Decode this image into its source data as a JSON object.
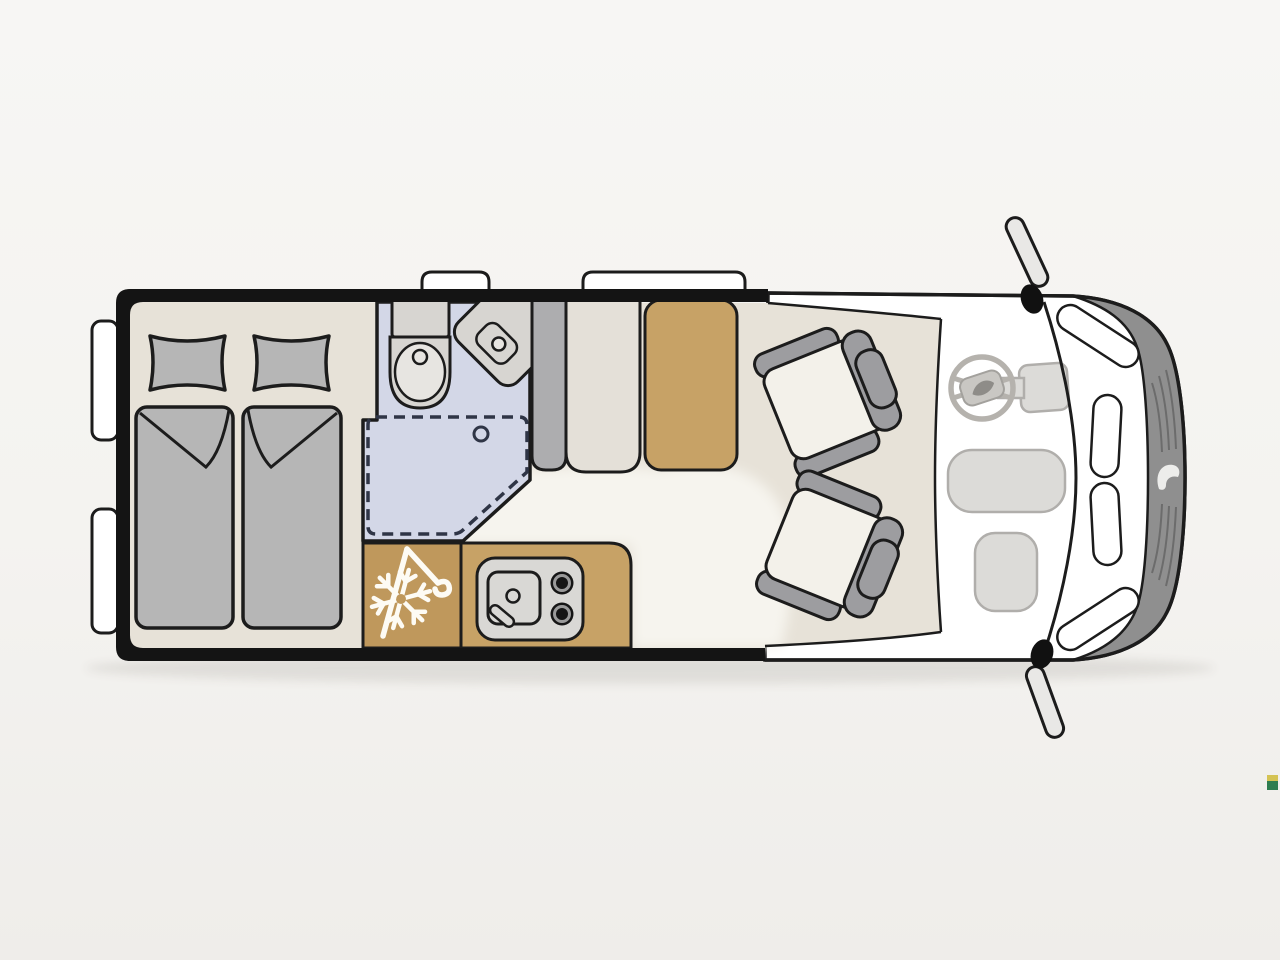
{
  "diagram": {
    "kind": "motorhome-floorplan-top-view",
    "orientation": "front-right",
    "areas": [
      "rear-twin-beds",
      "bathroom",
      "shower",
      "kitchen",
      "refrigerator",
      "side-bench",
      "dinette-table",
      "driver-swivel-seat",
      "passenger-swivel-seat",
      "cab-dashboard",
      "vehicle-front"
    ]
  },
  "icons": [
    "snowflake-icon",
    "coat-hanger-icon",
    "burner-icon",
    "sink-faucet-icon",
    "steering-wheel-icon",
    "brand-leaf-logo",
    "brand-grille-logo",
    "side-mirror-icon"
  ],
  "palette": {
    "bg_top": "#f7f6f4",
    "bg_bottom": "#efedea",
    "outline": "#1c1c1c",
    "wall": "#141414",
    "body": "#ffffff",
    "floor": "#e7e2d8",
    "walkway": "#f6f4ee",
    "bath": "#d3d7e7",
    "bath_line": "#2f3546",
    "bed_gray": "#b6b6b6",
    "fixture": "#d7d5d1",
    "fixture_light": "#e7e5e1",
    "seat_gray": "#9d9da0",
    "backrest": "#adadaf",
    "bench": "#e4e0d8",
    "cushion": "#f3f1ea",
    "wood": "#c7a266",
    "wood_dark": "#bf985c",
    "module": "#d9d8d5",
    "cab_floor": "#f8f7f5",
    "dash_fill": "#dcdbd8",
    "dash_stroke": "#b0aeab",
    "wheel": "#b5b2ad",
    "front_band": "#8f8f8f",
    "grille_line": "#6c6c6c",
    "icon_white": "#fdfbf4",
    "burner_ring": "#9a9a9a",
    "watermark_green": "#2e7d4f",
    "watermark_yellow": "#d4c353"
  }
}
